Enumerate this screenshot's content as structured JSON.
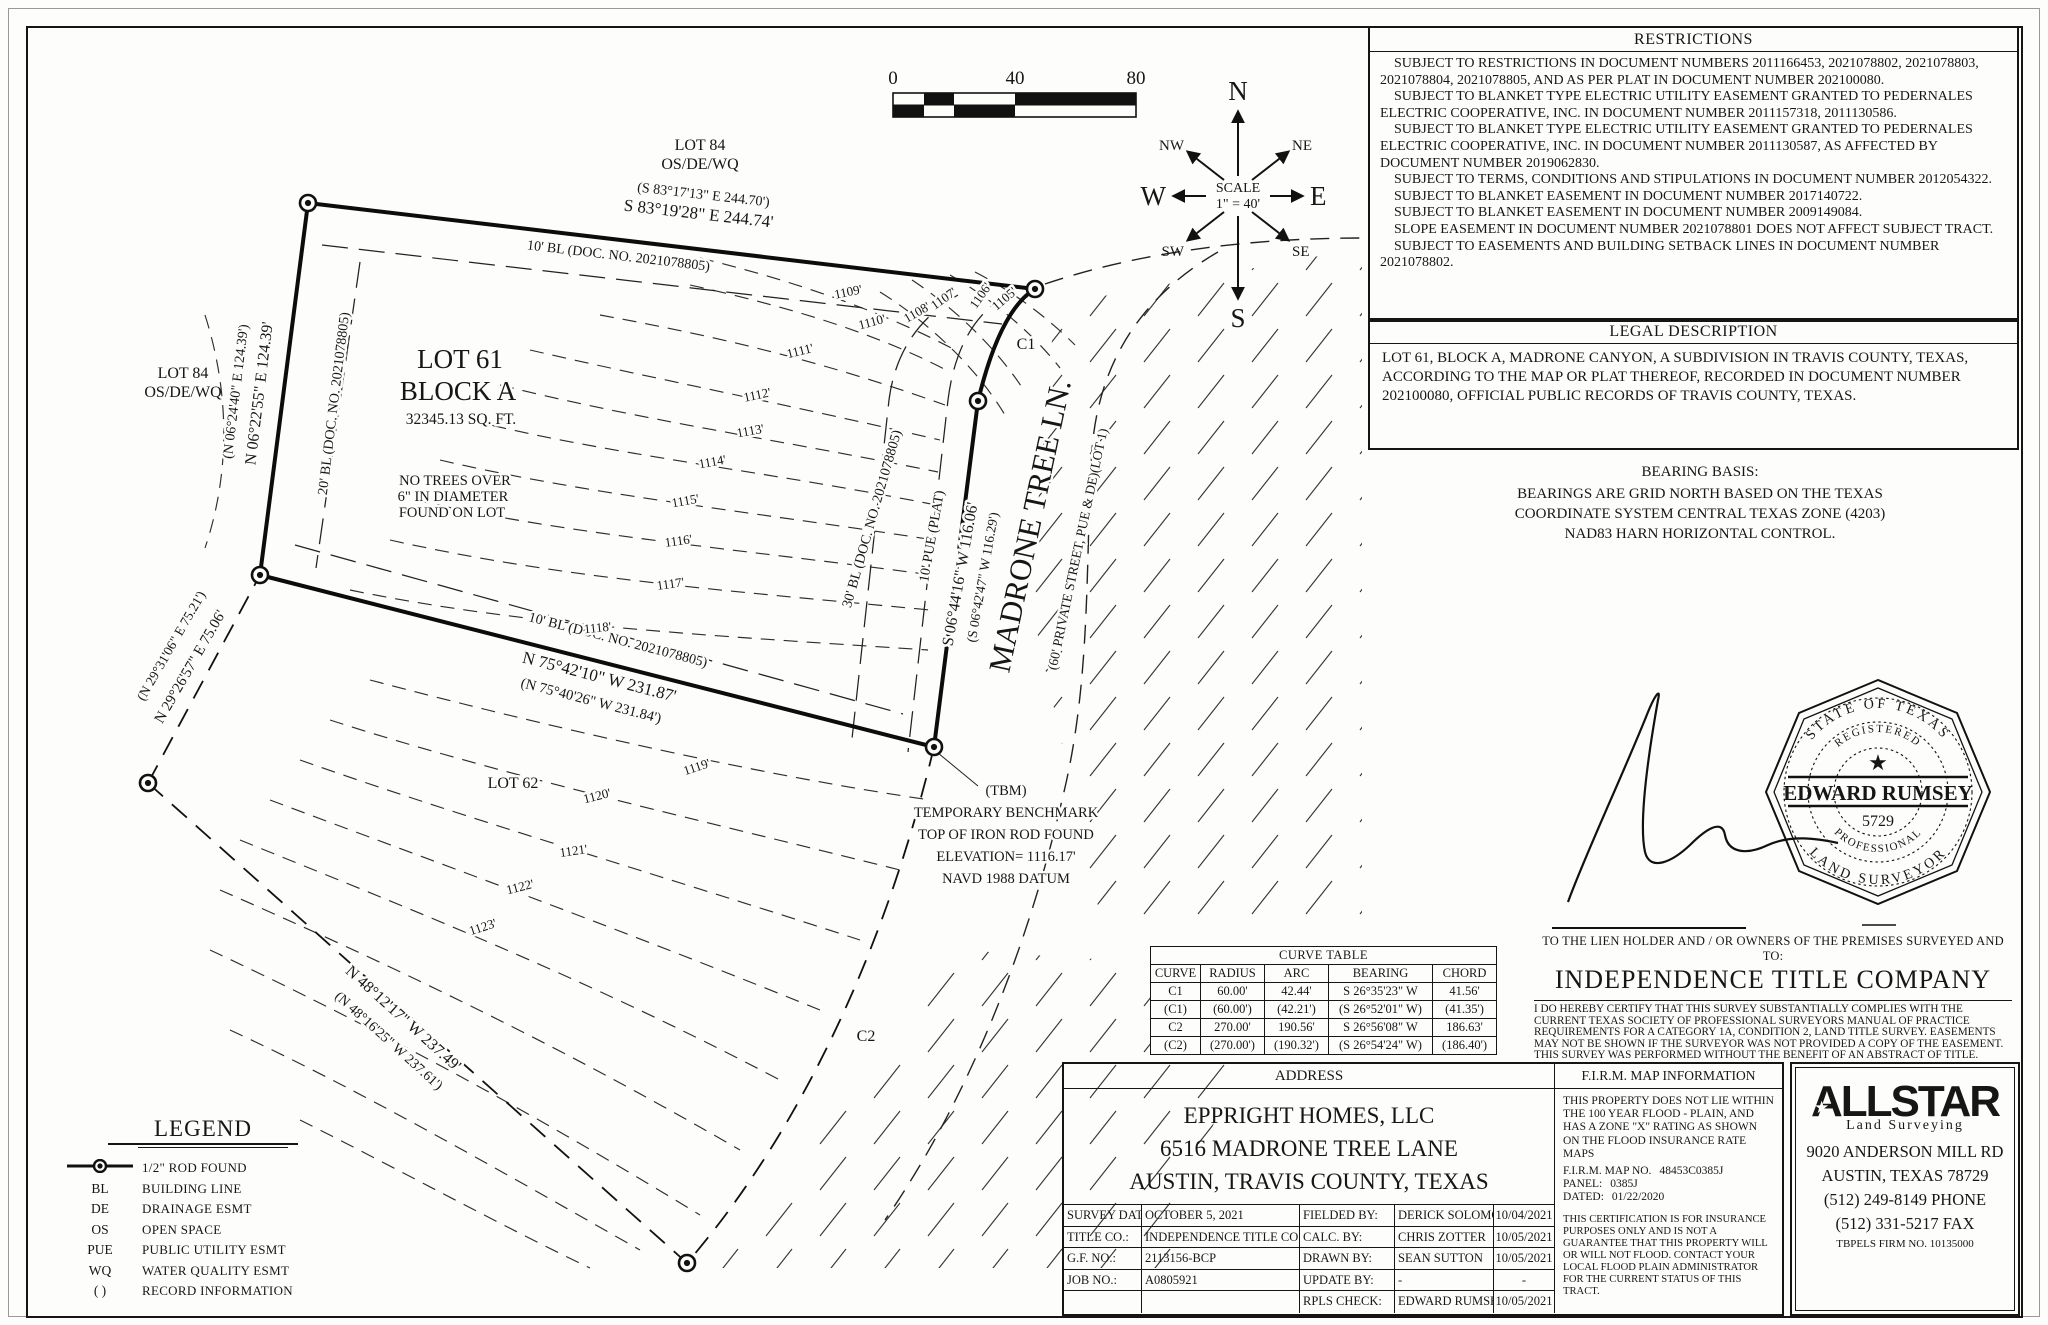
{
  "plat": {
    "scale_bar": {
      "t0": "0",
      "t40": "40",
      "t80": "80"
    },
    "compass": {
      "n": "N",
      "s": "S",
      "e": "E",
      "w": "W",
      "ne": "NE",
      "nw": "NW",
      "se": "SE",
      "sw": "SW",
      "scale_word": "SCALE",
      "scale_value": "1\" = 40'"
    },
    "labels": {
      "lot84_top_1": "LOT 84",
      "lot84_top_2": "OS/DE/WQ",
      "top_rec": "(S 83°17'13\" E  244.70')",
      "top_meas": "S 83°19'28\" E  244.74'",
      "top_bl": "10' BL (DOC. NO. 2021078805)",
      "lot84_left_1": "LOT 84",
      "lot84_left_2": "OS/DE/WQ",
      "west_rec": "(N 06°24'40\" E  124.39')",
      "west_meas": "N 06°22'55\" E  124.39'",
      "west_bl": "20' BL (DOC. NO. 2021078805)",
      "sw_rec": "(N 29°31'06\" E  75.21')",
      "sw_meas": "N 29°26'57\" E  75.06'",
      "south_bl": "10' BL (DOC. NO. 2021078805)",
      "south_meas": "N 75°42'10\" W  231.87'",
      "south_rec": "(N 75°40'26\" W  231.84')",
      "street_name": "MADRONE TREE LN.",
      "street_sub": "(60' PRIVATE STREET, PUE & DE)(LOT 1)",
      "street_meas": "S 06°44'16\" W  116.06'",
      "street_rec": "(S 06°42'47\" W  116.29')",
      "pue": "10' PUE (PLAT)",
      "street_bl": "30' BL (DOC. NO. 2021078805)",
      "c1": "C1",
      "c2": "C2",
      "lot61": "LOT 61",
      "blocka": "BLOCK A",
      "sqft": "32345.13 SQ. FT.",
      "notrees1": "NO TREES OVER",
      "notrees2": "6\" IN DIAMETER",
      "notrees3": "FOUND ON LOT",
      "lot62": "LOT 62",
      "n48_meas": "N 48°12'17\" W  237.49'",
      "n48_rec": "(N 48°16'25\" W  237.61')",
      "tbm_1": "(TBM)",
      "tbm_2": "TEMPORARY BENCHMARK",
      "tbm_3": "TOP OF IRON ROD FOUND",
      "tbm_4": "ELEVATION= 1116.17'",
      "tbm_5": "NAVD 1988 DATUM"
    },
    "contour_labels": [
      "1105'",
      "1106'",
      "1107'",
      "1108'",
      "1109'",
      "1110'",
      "1111'",
      "1112'",
      "1113'",
      "1114'",
      "1115'",
      "1116'",
      "1117'",
      "1118'",
      "1119'",
      "1120'",
      "1121'",
      "1122'",
      "1123'"
    ]
  },
  "restrictions": {
    "title": "RESTRICTIONS",
    "lines": [
      "SUBJECT TO RESTRICTIONS IN DOCUMENT NUMBERS 2011166453, 2021078802, 2021078803, 2021078804, 2021078805, AND AS PER PLAT IN DOCUMENT NUMBER 202100080.",
      "SUBJECT TO BLANKET TYPE ELECTRIC UTILITY EASEMENT GRANTED TO PEDERNALES ELECTRIC COOPERATIVE, INC. IN DOCUMENT NUMBER 2011157318, 2011130586.",
      "SUBJECT TO BLANKET TYPE ELECTRIC UTILITY EASEMENT GRANTED TO PEDERNALES ELECTRIC COOPERATIVE, INC. IN DOCUMENT NUMBER 2011130587, AS AFFECTED BY DOCUMENT NUMBER 2019062830.",
      "SUBJECT TO TERMS, CONDITIONS AND STIPULATIONS IN DOCUMENT NUMBER 2012054322.",
      "SUBJECT TO BLANKET EASEMENT IN DOCUMENT NUMBER 2017140722.",
      "SUBJECT TO BLANKET EASEMENT IN DOCUMENT NUMBER 2009149084.",
      "SLOPE EASEMENT IN DOCUMENT NUMBER 2021078801 DOES NOT AFFECT SUBJECT TRACT.",
      "SUBJECT TO EASEMENTS AND BUILDING SETBACK LINES IN DOCUMENT NUMBER 2021078802."
    ]
  },
  "legal": {
    "title": "LEGAL DESCRIPTION",
    "text": "LOT 61, BLOCK A, MADRONE CANYON, A SUBDIVISION IN TRAVIS COUNTY, TEXAS, ACCORDING TO THE MAP OR PLAT THEREOF, RECORDED IN DOCUMENT NUMBER 202100080, OFFICIAL PUBLIC RECORDS OF TRAVIS COUNTY, TEXAS."
  },
  "bearing_basis": {
    "title": "BEARING BASIS:",
    "line1": "BEARINGS ARE GRID NORTH BASED ON THE TEXAS",
    "line2": "COORDINATE SYSTEM CENTRAL TEXAS ZONE (4203)",
    "line3": "NAD83 HARN HORIZONTAL CONTROL."
  },
  "seal": {
    "top": "STATE OF TEXAS",
    "registered": "REGISTERED",
    "star_icon": "★",
    "name": "EDWARD RUMSEY",
    "number": "5729",
    "professional": "PROFESSIONAL",
    "bottom": "LAND SURVEYOR"
  },
  "certification": {
    "lien": "TO THE LIEN HOLDER AND / OR OWNERS OF THE PREMISES SURVEYED AND TO:",
    "company": "INDEPENDENCE TITLE COMPANY",
    "body": "I DO HEREBY CERTIFY THAT THIS SURVEY SUBSTANTIALLY COMPLIES WITH THE CURRENT TEXAS SOCIETY OF PROFESSIONAL SURVEYORS MANUAL OF PRACTICE REQUIREMENTS FOR A CATEGORY 1A, CONDITION 2, LAND TITLE SURVEY. EASEMENTS MAY NOT BE SHOWN IF THE SURVEYOR WAS NOT PROVIDED A COPY OF THE EASEMENT. THIS SURVEY WAS PERFORMED WITHOUT THE BENEFIT OF AN ABSTRACT OF TITLE."
  },
  "curve_table": {
    "title": "CURVE TABLE",
    "headers": [
      "CURVE",
      "RADIUS",
      "ARC",
      "BEARING",
      "CHORD"
    ],
    "rows": [
      [
        "C1",
        "60.00'",
        "42.44'",
        "S 26°35'23\" W",
        "41.56'"
      ],
      [
        "(C1)",
        "(60.00')",
        "(42.21')",
        "(S 26°52'01\" W)",
        "(41.35')"
      ],
      [
        "C2",
        "270.00'",
        "190.56'",
        "S 26°56'08\" W",
        "186.63'"
      ],
      [
        "(C2)",
        "(270.00')",
        "(190.32')",
        "(S 26°54'24\" W)",
        "(186.40')"
      ]
    ]
  },
  "address": {
    "title": "ADDRESS",
    "line1": "EPPRIGHT HOMES, LLC",
    "line2": "6516 MADRONE TREE LANE",
    "line3": "AUSTIN, TRAVIS COUNTY, TEXAS"
  },
  "survey_info": {
    "rows": [
      {
        "l1": "SURVEY DATE:",
        "v1": "OCTOBER 5, 2021",
        "l2": "FIELDED BY:",
        "v2": "DERICK SOLOMON",
        "d": "10/04/2021"
      },
      {
        "l1": "TITLE CO.:",
        "v1": "INDEPENDENCE TITLE CO.",
        "l2": "CALC. BY:",
        "v2": "CHRIS ZOTTER",
        "d": "10/05/2021"
      },
      {
        "l1": "G.F. NO.:",
        "v1": "2113156-BCP",
        "l2": "DRAWN BY:",
        "v2": "SEAN SUTTON",
        "d": "10/05/2021"
      },
      {
        "l1": "JOB NO.:",
        "v1": "A0805921",
        "l2": "UPDATE BY:",
        "v2": "-",
        "d": "-"
      },
      {
        "l1": "",
        "v1": "",
        "l2": "RPLS CHECK:",
        "v2": "EDWARD RUMSEY",
        "d": "10/05/2021"
      }
    ]
  },
  "firm": {
    "title": "F.I.R.M. MAP INFORMATION",
    "body": "THIS PROPERTY DOES NOT LIE WITHIN THE 100 YEAR FLOOD - PLAIN, AND HAS A ZONE  \"X\" RATING AS SHOWN ON THE FLOOD INSURANCE RATE MAPS",
    "map_label": "F.I.R.M. MAP NO.",
    "map_no": "48453C0385J",
    "panel_label": "PANEL:",
    "panel": "0385J",
    "dated_label": "DATED:",
    "dated": "01/22/2020",
    "note": "THIS CERTIFICATION IS FOR INSURANCE PURPOSES ONLY AND IS NOT A GUARANTEE THAT THIS PROPERTY WILL OR WILL NOT FLOOD. CONTACT YOUR LOCAL FLOOD PLAIN ADMINISTRATOR FOR THE CURRENT STATUS OF THIS TRACT."
  },
  "allstar": {
    "name": "ALLSTAR",
    "star_icon": "★",
    "tagline": "Land Surveying",
    "addr1": "9020 ANDERSON MILL RD",
    "addr2": "AUSTIN, TEXAS 78729",
    "addr3": "(512) 249-8149 PHONE",
    "addr4": "(512) 331-5217 FAX",
    "firm_no": "TBPELS FIRM NO. 10135000"
  },
  "legend": {
    "title": "LEGEND",
    "items": [
      {
        "sym": "",
        "label": "1/2\" ROD FOUND"
      },
      {
        "sym": "BL",
        "label": "BUILDING LINE"
      },
      {
        "sym": "DE",
        "label": "DRAINAGE ESMT"
      },
      {
        "sym": "OS",
        "label": "OPEN SPACE"
      },
      {
        "sym": "PUE",
        "label": "PUBLIC UTILITY ESMT"
      },
      {
        "sym": "WQ",
        "label": "WATER QUALITY ESMT"
      },
      {
        "sym": "( )",
        "label": "RECORD INFORMATION"
      }
    ]
  }
}
